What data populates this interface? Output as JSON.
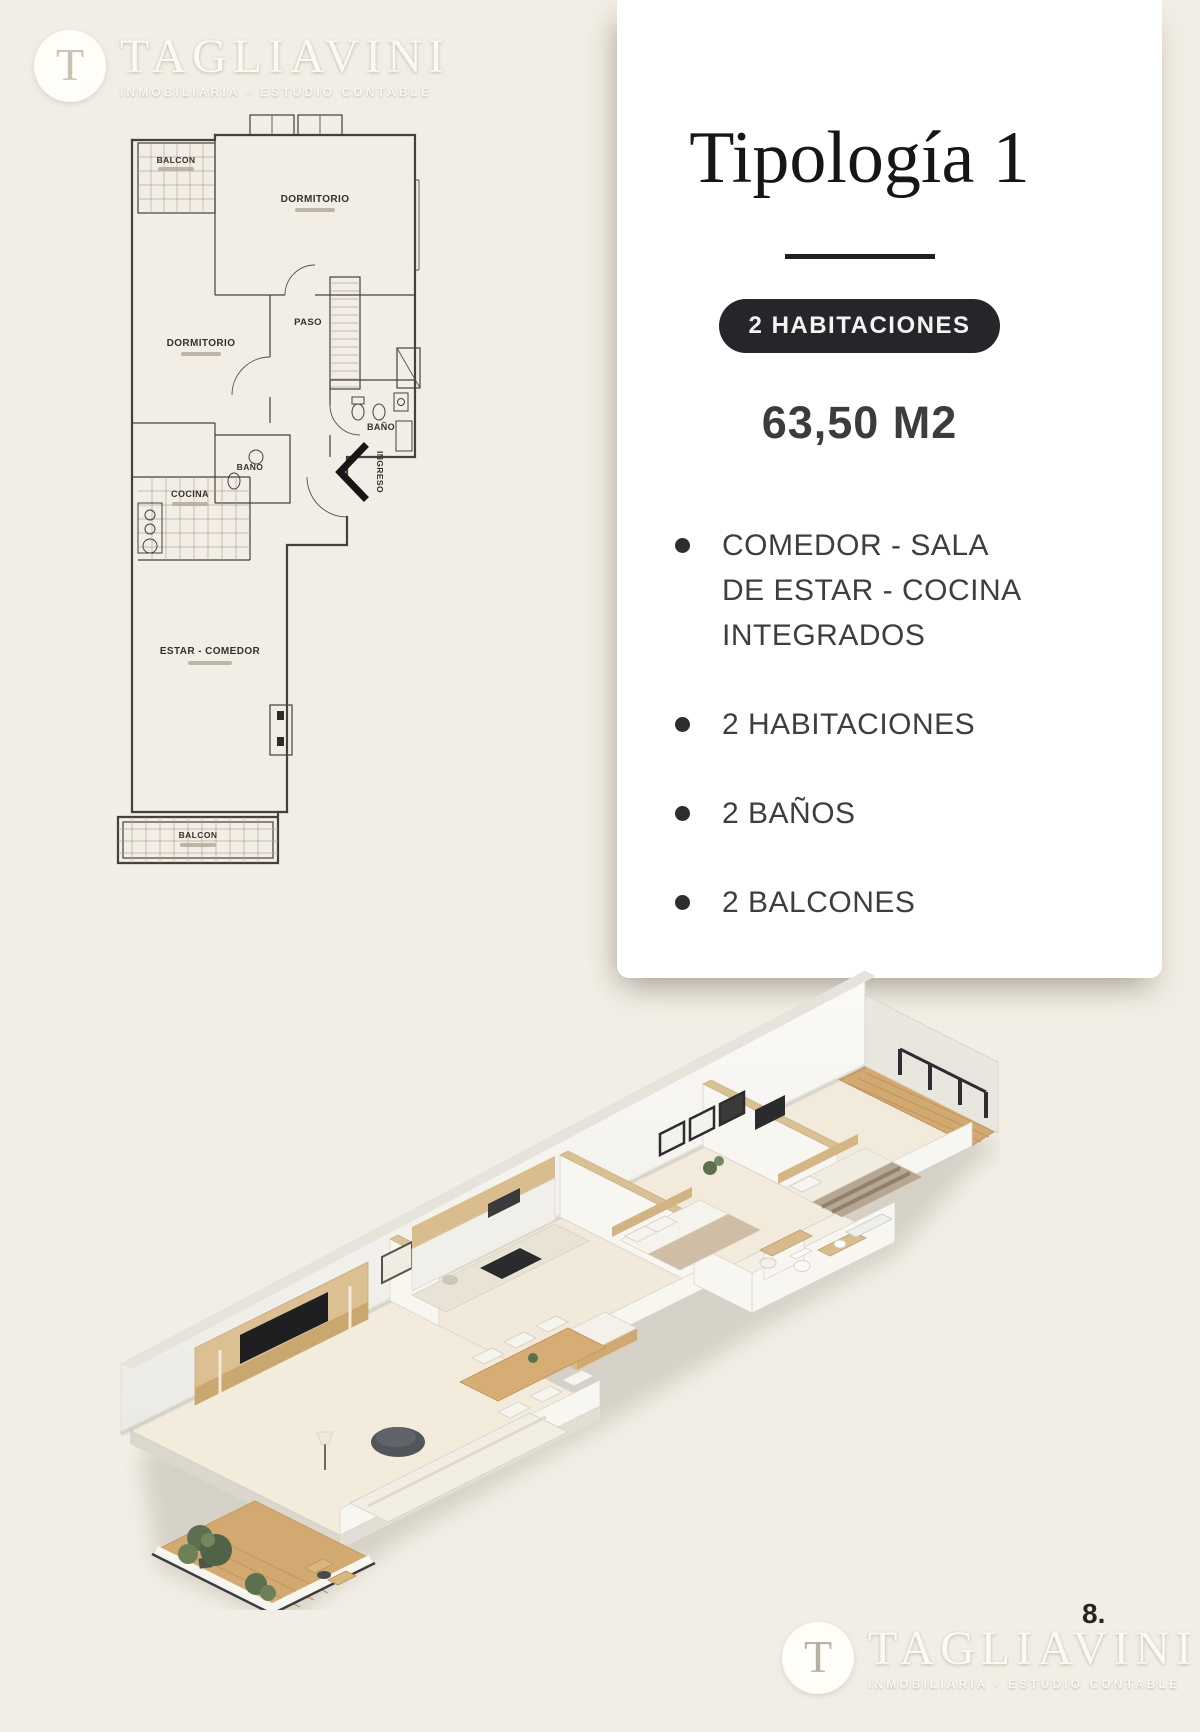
{
  "page": {
    "page_number": "8."
  },
  "logo": {
    "initial": "T",
    "name": "TAGLIAVINI",
    "tagline": "INMOBILIARIA - ESTUDIO CONTABLE"
  },
  "floorplan": {
    "labels": {
      "balcony_top": "BALCON",
      "bedroom_top": "DORMITORIO",
      "hall": "PASO",
      "bedroom_left": "DORMITORIO",
      "bath_right": "BAÑO",
      "bath_small": "BAÑO",
      "kitchen": "COCINA",
      "entry": "INGRESO",
      "living": "ESTAR - COMEDOR",
      "balcony_bottom": "BALCON"
    }
  },
  "card": {
    "title": "Tipología 1",
    "badge": "2 HABITACIONES",
    "area": "63,50 M2",
    "features": [
      "COMEDOR - SALA DE ESTAR - COCINA INTEGRADOS",
      "2 HABITACIONES",
      "2 BAÑOS",
      "2 BALCONES"
    ]
  },
  "colors": {
    "page_background": "#f2eee5",
    "card_background": "#ffffff",
    "badge_background": "#26262a",
    "text_primary": "#3e3e3e",
    "wood_accent": "#d2a970",
    "plant_green": "#5c7050"
  }
}
